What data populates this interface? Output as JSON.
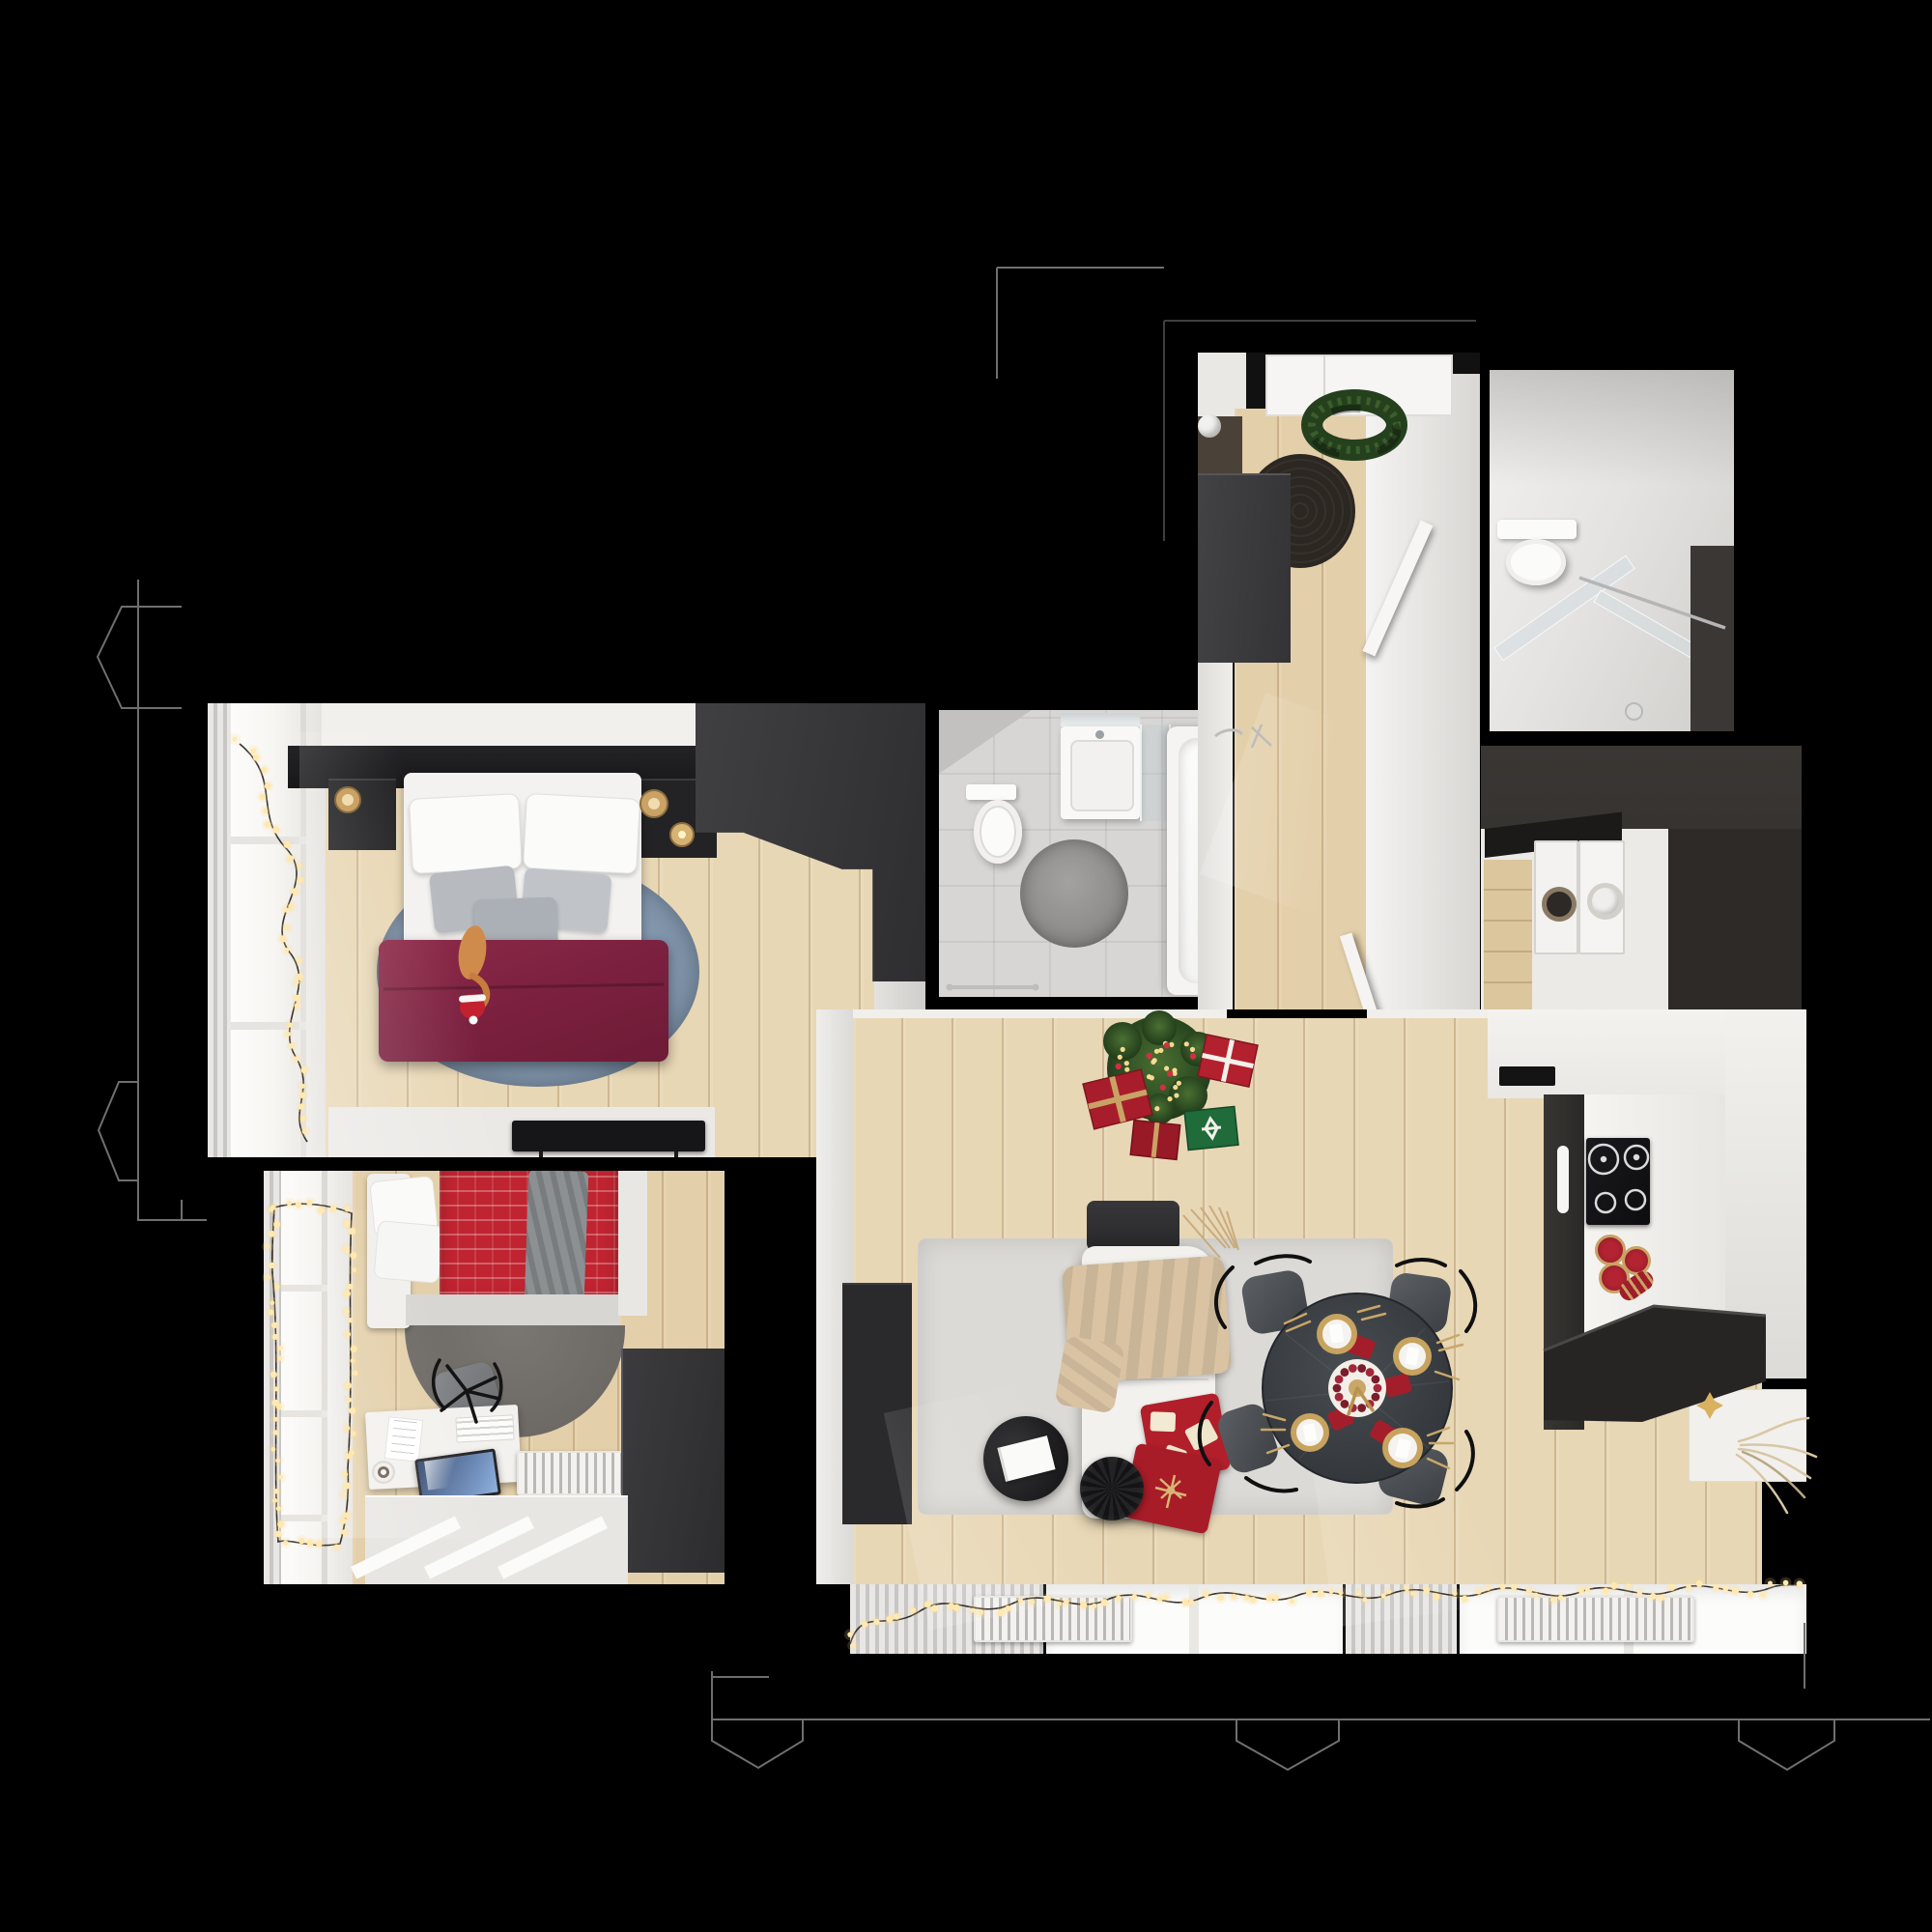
{
  "scene": {
    "type": "3d-floor-plan-top-view-render",
    "theme": "christmas-decorated-apartment",
    "visible_text": [],
    "background": "#000000"
  },
  "palette": {
    "bg": "#000000",
    "outline": "#6f6f6f",
    "outline_faint": "#3f3f3f",
    "wood": "#e8d7b5",
    "wood2": "#e3cfa9",
    "wood_line": "rgba(140,100,55,0.28)",
    "wall_white": "#f1f0ed",
    "wall_shadow": "#d8d7d4",
    "dark_furniture": "#3a393b",
    "dark_brown": "#4a4138",
    "black_furniture": "#18181a",
    "rug_blue": "#8094aa",
    "rug_gray": "#6d6965",
    "rug_dark": "#2b2723",
    "rug_bath": "#8f8e8c",
    "duvet": "#7d2140",
    "red_blanket": "#bf2430",
    "red_pillow": "#b11f2b",
    "throw_beige": "#d9c3a3",
    "sofa_white": "#f2f1ee",
    "tree_green": "#2f4e23",
    "present_red": "#a81d2b",
    "present_green": "#1f6b3a",
    "gold": "#c9a265",
    "light_warm": "#ffe9b0",
    "table_dark": "#3e4347",
    "chair_gray": "#53565a",
    "bath_floor": "#d7d6d4",
    "white_fixture": "#fbfbfa",
    "laundry_wall": "#353230",
    "cooktop": "#111114",
    "counter_black": "#262523",
    "curtain_a": "#e8e7e5",
    "curtain_b": "#c7c6c4",
    "screen_a": "#32476f",
    "screen_b": "#8fb2e0"
  },
  "effects": {
    "garland_dot_spacing": 13,
    "garland_dot_color": "#ffe9b0",
    "garland_halo_color": "#ffdf96",
    "garland_wire_color": "#171007",
    "tree_light_count": 26,
    "tree_bauble_count": 7,
    "tree_light_color": "#ffdf96",
    "tree_bauble_color": "#d03040"
  },
  "rooms": [
    {
      "id": "entry-hall",
      "items": [
        "entry-door",
        "christmas-wreath",
        "round-doormat",
        "tall-wardrobe",
        "shoe-cabinet",
        "ceiling-lamp",
        "wood-floor",
        "open-door-bathroom",
        "open-door-living"
      ]
    },
    {
      "id": "shower-bathroom",
      "items": [
        "wall-hung-toilet",
        "glass-shower-screen",
        "chrome-rail",
        "shower-head",
        "dark-storage-niche"
      ]
    },
    {
      "id": "laundry-room",
      "items": [
        "washing-machine",
        "dryer",
        "black-countertop",
        "wood-floor",
        "dark-wall"
      ]
    },
    {
      "id": "master-bedroom",
      "items": [
        "double-bed",
        "white-pillows",
        "gray-pillows",
        "burgundy-duvet",
        "cat-with-santa-hat",
        "black-headboard",
        "nightstand-left",
        "nightstand-right",
        "gold-bedside-lamps",
        "candle",
        "round-blue-rug",
        "corner-wardrobe",
        "window-fairy-lights",
        "curtain",
        "tv-bench",
        "tv"
      ]
    },
    {
      "id": "family-bathroom",
      "items": [
        "toilet",
        "vanity-sink",
        "mirror",
        "glass-panel",
        "bathtub",
        "chrome-faucet",
        "round-gray-rug",
        "towel-rail",
        "tile-floor"
      ]
    },
    {
      "id": "home-office-bedroom",
      "items": [
        "single-bed",
        "white-pillows",
        "red-pattern-blanket",
        "gray-throw",
        "semicircle-rug",
        "office-chair",
        "white-desk",
        "monitor",
        "keyboard",
        "papers",
        "coffee-mug",
        "radiator",
        "wardrobe",
        "window-fairy-lights",
        "curtain"
      ]
    },
    {
      "id": "living-room",
      "items": [
        "christmas-tree",
        "string-lights",
        "gift-boxes",
        "white-sofa",
        "dark-headrest",
        "beige-throw",
        "red-christmas-pillows",
        "round-coffee-table",
        "notebook",
        "pleated-pouf",
        "area-rug",
        "tv-cabinet",
        "round-dining-table",
        "four-dining-chairs",
        "gold-place-settings",
        "red-napkins",
        "berry-wreath-centerpiece",
        "window-fairy-lights",
        "radiators",
        "curtains",
        "windows"
      ]
    },
    {
      "id": "kitchen",
      "items": [
        "induction-cooktop",
        "oven-handle",
        "white-countertop",
        "black-countertop",
        "sink-slot",
        "red-gold-canisters",
        "white-cabinet",
        "gold-star",
        "decorative-branches",
        "dark-lower-cabinets"
      ]
    }
  ],
  "building_outline": {
    "color": "#6f6f6f",
    "features": [
      "left-bay-window-upper",
      "left-bay-window-lower",
      "bottom-bay-window-left",
      "bottom-bay-window-center",
      "bottom-bay-window-right",
      "exterior-wall-lines"
    ]
  }
}
